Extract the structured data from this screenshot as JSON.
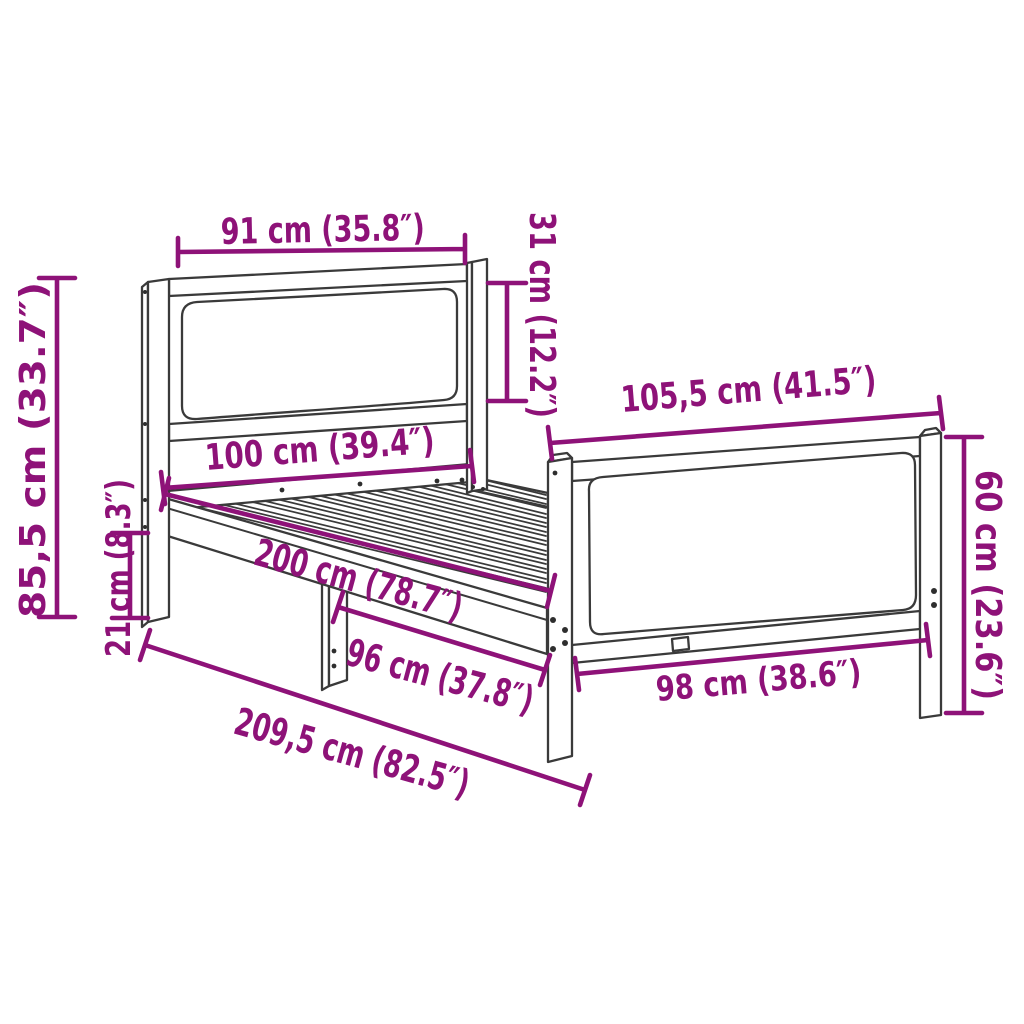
{
  "diagram": {
    "type": "furniture-dimension-diagram",
    "subject": "bed frame with headboard and footboard",
    "background_color": "#ffffff",
    "frame_color": "#3a3a3a",
    "dimension_color": "#8e1278"
  },
  "dimensions": [
    {
      "id": "headboard-width",
      "label": "91 cm (35.8″)"
    },
    {
      "id": "headboard-cushion-height",
      "label": "31 cm (12.2″)"
    },
    {
      "id": "footboard-width",
      "label": "105,5 cm (41.5″)"
    },
    {
      "id": "footboard-height",
      "label": "60 cm (23.6″)"
    },
    {
      "id": "headboard-height",
      "label": "85,5 cm (33.7″)"
    },
    {
      "id": "leg-height",
      "label": "21 cm (8.3″)"
    },
    {
      "id": "bed-width",
      "label": "100 cm (39.4″)"
    },
    {
      "id": "bed-length",
      "label": "200 cm (78.7″)"
    },
    {
      "id": "frame-inner-length",
      "label": "96 cm (37.8″)"
    },
    {
      "id": "footboard-inner-width",
      "label": "98 cm (38.6″)"
    },
    {
      "id": "total-length",
      "label": "209,5 cm (82.5″)"
    }
  ]
}
